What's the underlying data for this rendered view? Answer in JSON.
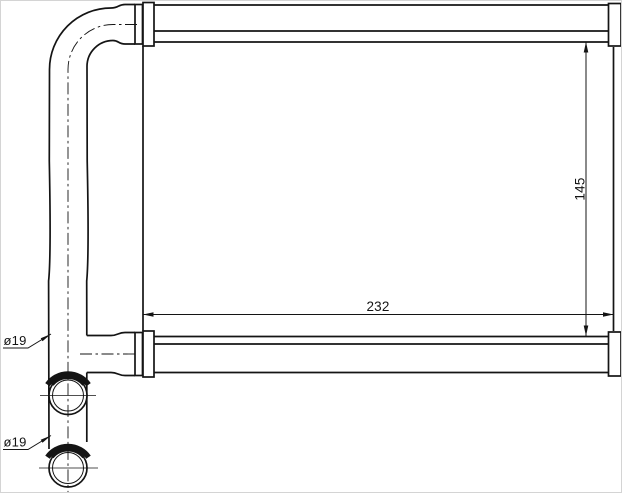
{
  "drawing": {
    "line_color": "#141414",
    "background_color": "#ffffff",
    "dimensions": {
      "core_width": "232",
      "core_height": "145"
    },
    "labels": {
      "pipe_diameter_top": "ø19",
      "pipe_diameter_bottom": "ø19"
    }
  }
}
